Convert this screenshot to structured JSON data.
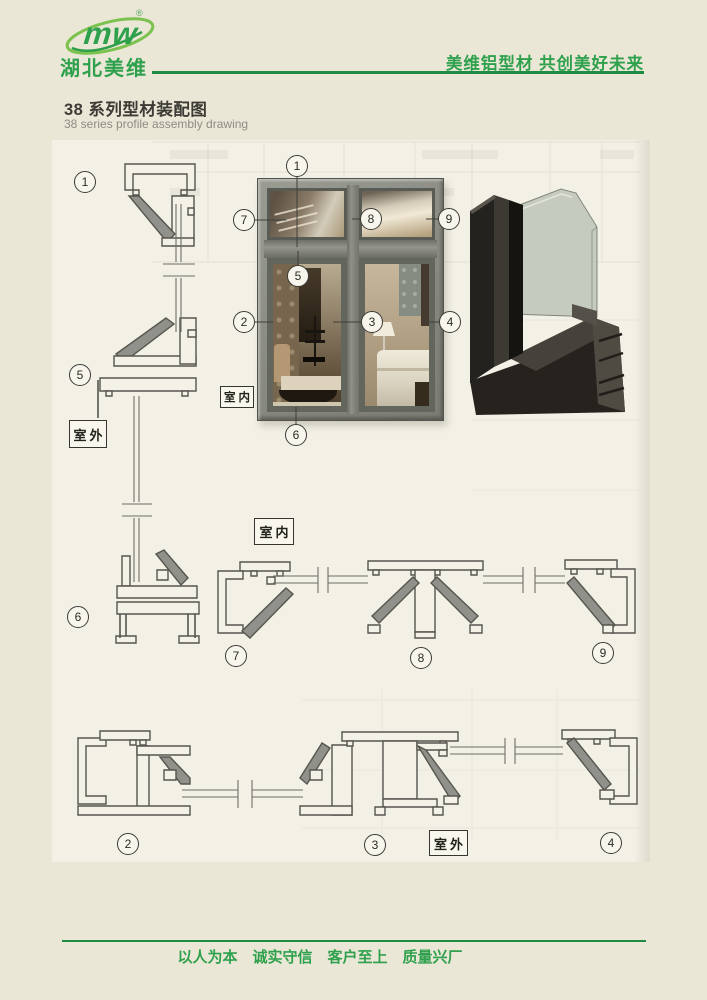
{
  "header": {
    "logo_mark": "mw",
    "registered": "®",
    "company": "湖北美维",
    "slogan": "美维铝型材 共创美好未来"
  },
  "title": {
    "zh": "38 系列型材装配图",
    "en": "38 series profile assembly drawing"
  },
  "labels": {
    "indoor": "室内",
    "outdoor": "室外"
  },
  "callouts": {
    "c1": "1",
    "c2": "2",
    "c3": "3",
    "c4": "4",
    "c5": "5",
    "c6": "6",
    "c7": "7",
    "c8": "8",
    "c9": "9"
  },
  "footer": {
    "motto": "以人为本　诚实守信　客户至上　质量兴厂"
  },
  "colors": {
    "brand_green": "#2fa14d",
    "rule_green": "#1e8c44",
    "paper": "#ebe7d7",
    "panel": "#f3f1e6",
    "line": "#55544e"
  }
}
